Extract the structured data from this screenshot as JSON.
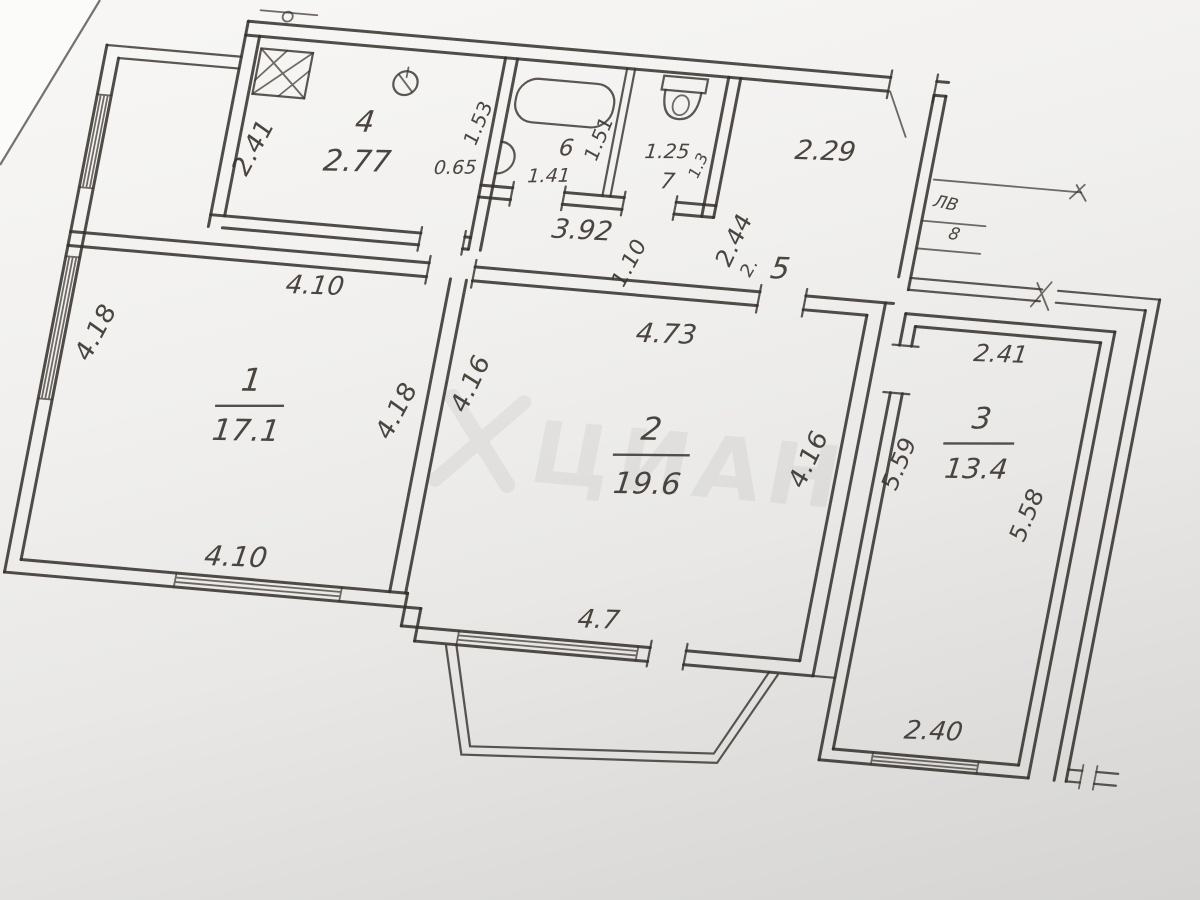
{
  "plan": {
    "watermark": "ЦИАН",
    "rooms": {
      "room1": {
        "number": "1",
        "area": "17.1",
        "dim_top": "4.10",
        "dim_left": "4.18",
        "dim_right": "4.18",
        "dim_bottom": "4.10"
      },
      "room2": {
        "number": "2",
        "area": "19.6",
        "dim_top": "4.73",
        "dim_left": "4.16",
        "dim_right": "4.16",
        "dim_bottom": "4.7"
      },
      "room3": {
        "number": "3",
        "area": "13.4",
        "dim_top": "2.41",
        "dim_left": "5.59",
        "dim_right": "5.58",
        "dim_bottom": "2.40"
      },
      "kitchen": {
        "number": "4",
        "value": "2.77",
        "dim_left": "2.41"
      },
      "hall": {
        "number": "5",
        "note": "2.",
        "dim_top": "2.29",
        "dim_side": "2.44"
      },
      "bath": {
        "number": "6",
        "value": "1.41",
        "dim_left": "1.53",
        "dim_door": "0.65",
        "dim_right": "1.51"
      },
      "wc": {
        "number": "7",
        "value": "1.25",
        "dim_right": "1.3"
      }
    },
    "corridor": {
      "dim_length": "3.92",
      "dim_width": "1.10"
    },
    "stairwell": {
      "label": "ЛВ",
      "number": "8"
    }
  }
}
